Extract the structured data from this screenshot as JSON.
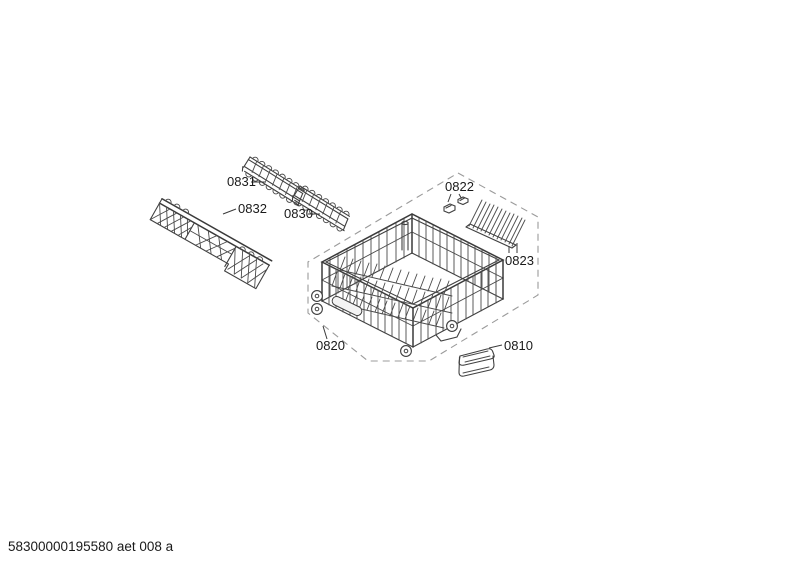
{
  "callouts": {
    "p0831": "0831",
    "p0832": "0832",
    "p0830": "0830",
    "p0822": "0822",
    "p0823": "0823",
    "p0820": "0820",
    "p0810": "0810"
  },
  "footer": {
    "code": "58300000195580 aet 008 a"
  },
  "colors": {
    "line": "#404040",
    "dashed_boundary": "#9b9b9b",
    "text": "#1a1a1a",
    "background": "#ffffff"
  }
}
